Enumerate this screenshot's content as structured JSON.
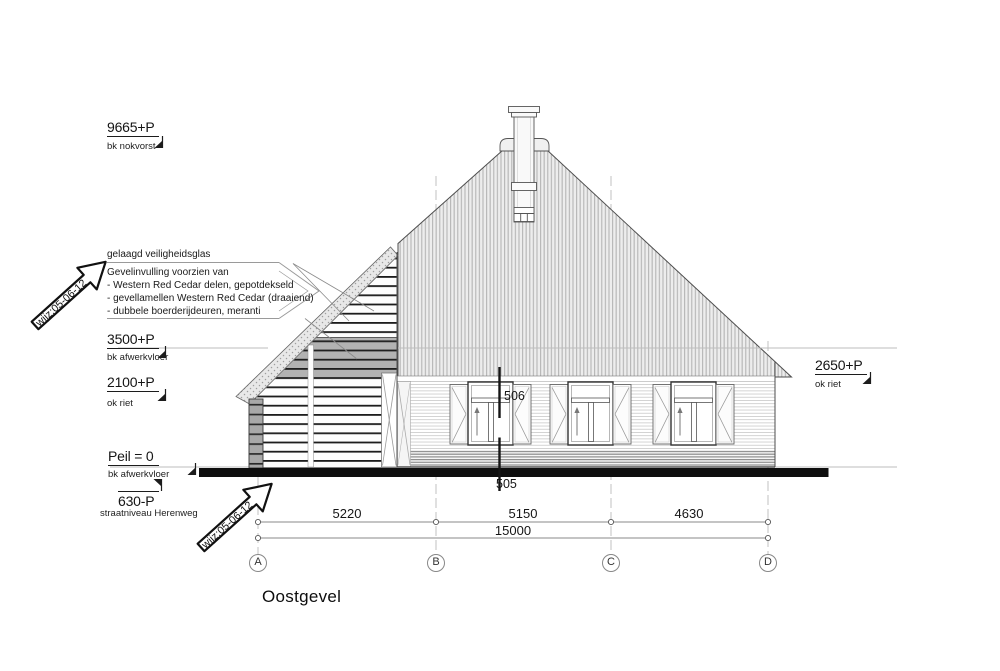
{
  "drawing": {
    "title": "Oostgevel",
    "levels": {
      "nok": {
        "value": "9665+P",
        "label": "bk nokvorst"
      },
      "floor2": {
        "value": "3500+P",
        "label": "bk afwerkvloer"
      },
      "riet_left": {
        "value": "2100+P",
        "label": "ok riet"
      },
      "peil": {
        "value": "Peil = 0",
        "label": "bk afwerkvloer"
      },
      "street": {
        "value": "630-P",
        "label": "straatniveau Herenweg"
      },
      "riet_right": {
        "value": "2650+P",
        "label": "ok riet"
      }
    },
    "annotations": {
      "glass": "gelaagd veiligheidsglas",
      "infill_title": "Gevelinvulling voorzien van",
      "infill_item1": "- Western Red Cedar delen, gepotdekseld",
      "infill_item2": "- gevellamellen Western Red Cedar (draaiend)",
      "infill_item3": "- dubbele boerderijdeuren, meranti",
      "revision": "wijz:05-06-12"
    },
    "section_refs": {
      "upper": "506",
      "lower": "505"
    },
    "dimensions": {
      "d_ab": "5220",
      "d_bc": "5150",
      "d_cd": "4630",
      "total": "15000"
    },
    "grid": {
      "a": "A",
      "b": "B",
      "c": "C",
      "d": "D"
    }
  }
}
